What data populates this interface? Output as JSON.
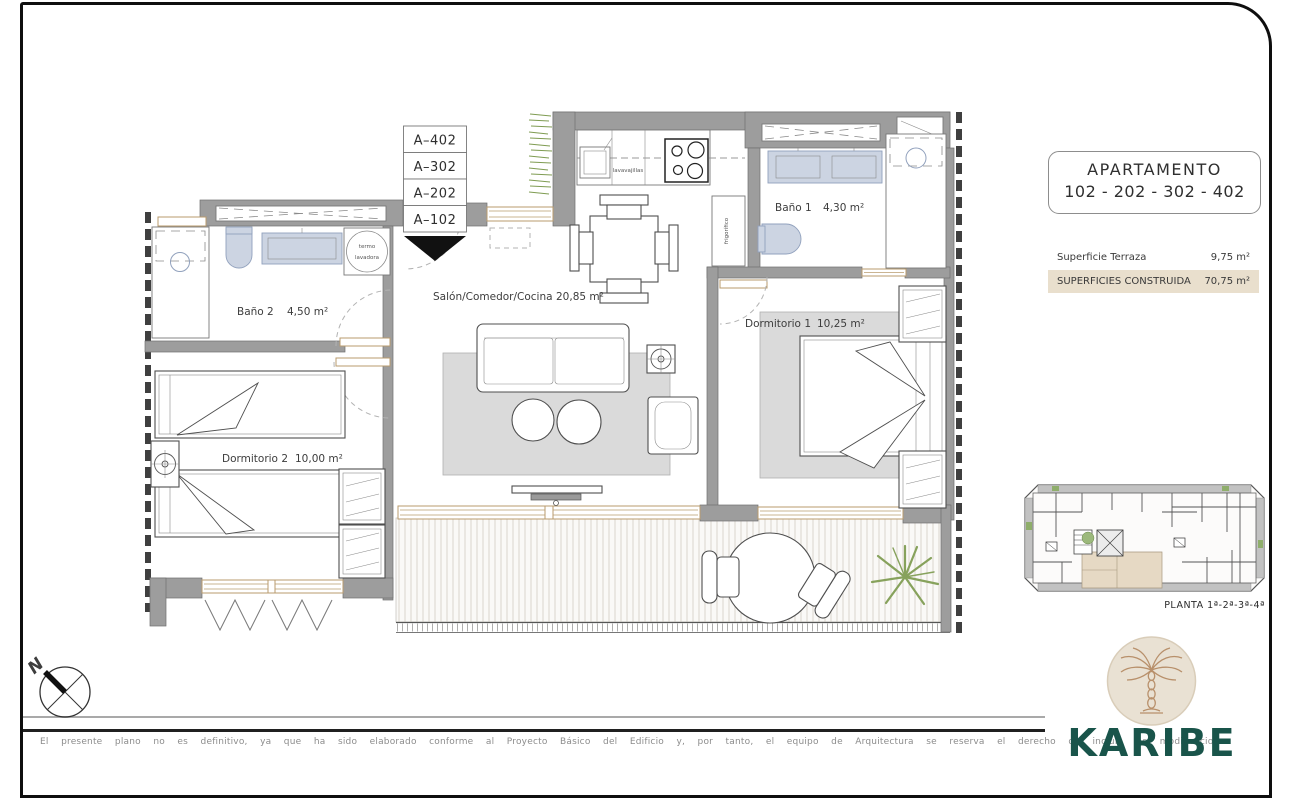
{
  "plan": {
    "unit_labels": [
      "A–402",
      "A–302",
      "A–202",
      "A–102"
    ],
    "rooms": [
      {
        "name": "Baño 2",
        "area": "4,50 m²"
      },
      {
        "name": "Salón/Comedor/Cocina",
        "area": "20,85 m²"
      },
      {
        "name": "Baño 1",
        "area": "4,30 m²"
      },
      {
        "name": "Dormitorio 1",
        "area": "10,25 m²"
      },
      {
        "name": "Dormitorio 2",
        "area": "10,00 m²"
      }
    ],
    "appliances": {
      "dishwasher": "lavavajillas",
      "fridge": "frigorífico",
      "boiler_line1": "termo",
      "boiler_line2": "lavadora"
    },
    "compass_north": "N"
  },
  "info_panel": {
    "title": "APARTAMENTO",
    "units": "102 - 202 - 302 - 402",
    "rows": [
      {
        "label": "Superficie Terraza",
        "value": "9,75 m²"
      },
      {
        "label": "SUPERFICIES CONSTRUIDA",
        "value": "70,75 m²"
      }
    ],
    "floor_label": "PLANTA 1ª-2ª-3ª-4ª",
    "brand": "KARIBE"
  },
  "footer": {
    "disclaimer": "El presente plano no es definitivo, ya que ha sido elaborado conforme al Proyecto Básico del Edificio y, por tanto, el equipo de Arquitectura se reserva el derecho de incluir las modificaciones"
  }
}
